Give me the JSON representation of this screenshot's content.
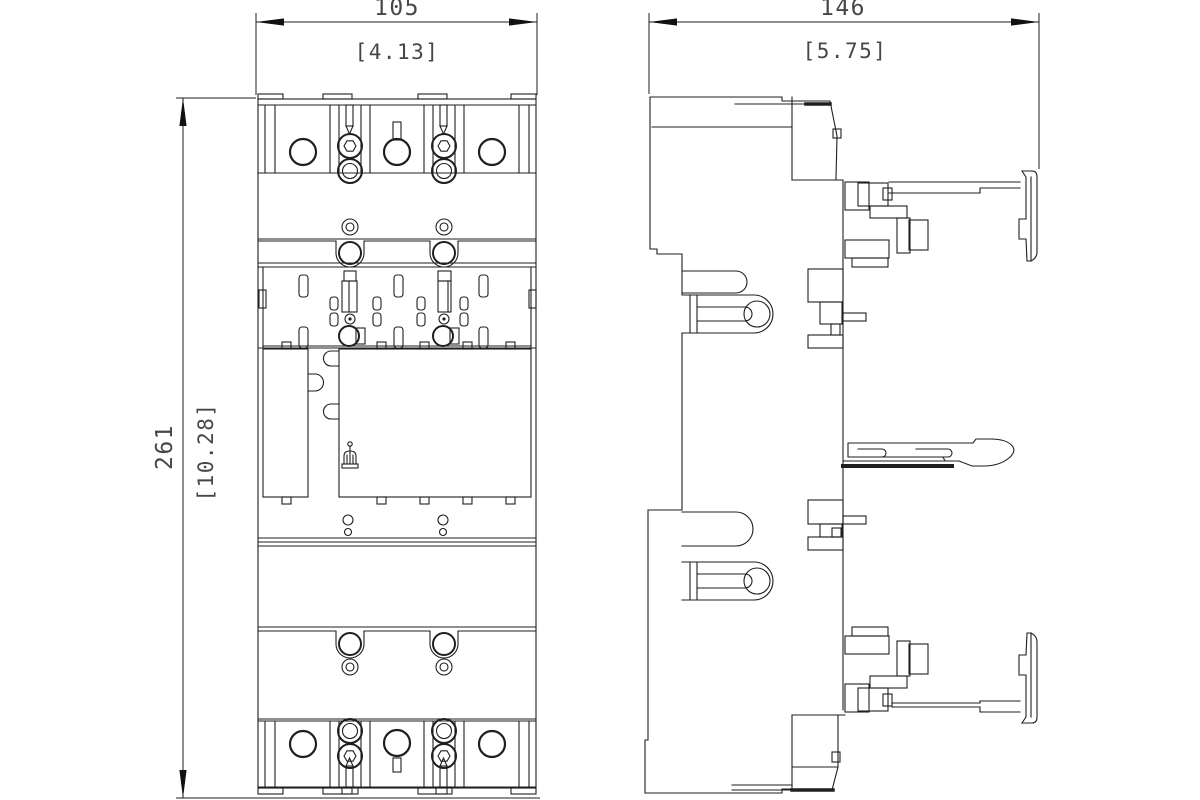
{
  "page": {
    "background": "#ffffff",
    "line_color": "#1f1f1f",
    "dim_text_color": "#474747",
    "arrow_color": "#111111"
  },
  "dimensions": {
    "width": {
      "mm": "105",
      "inch": "[4.13]"
    },
    "depth": {
      "mm": "146",
      "inch": "[5.75]"
    },
    "height": {
      "mm": "261",
      "inch": "[10.28]"
    }
  }
}
